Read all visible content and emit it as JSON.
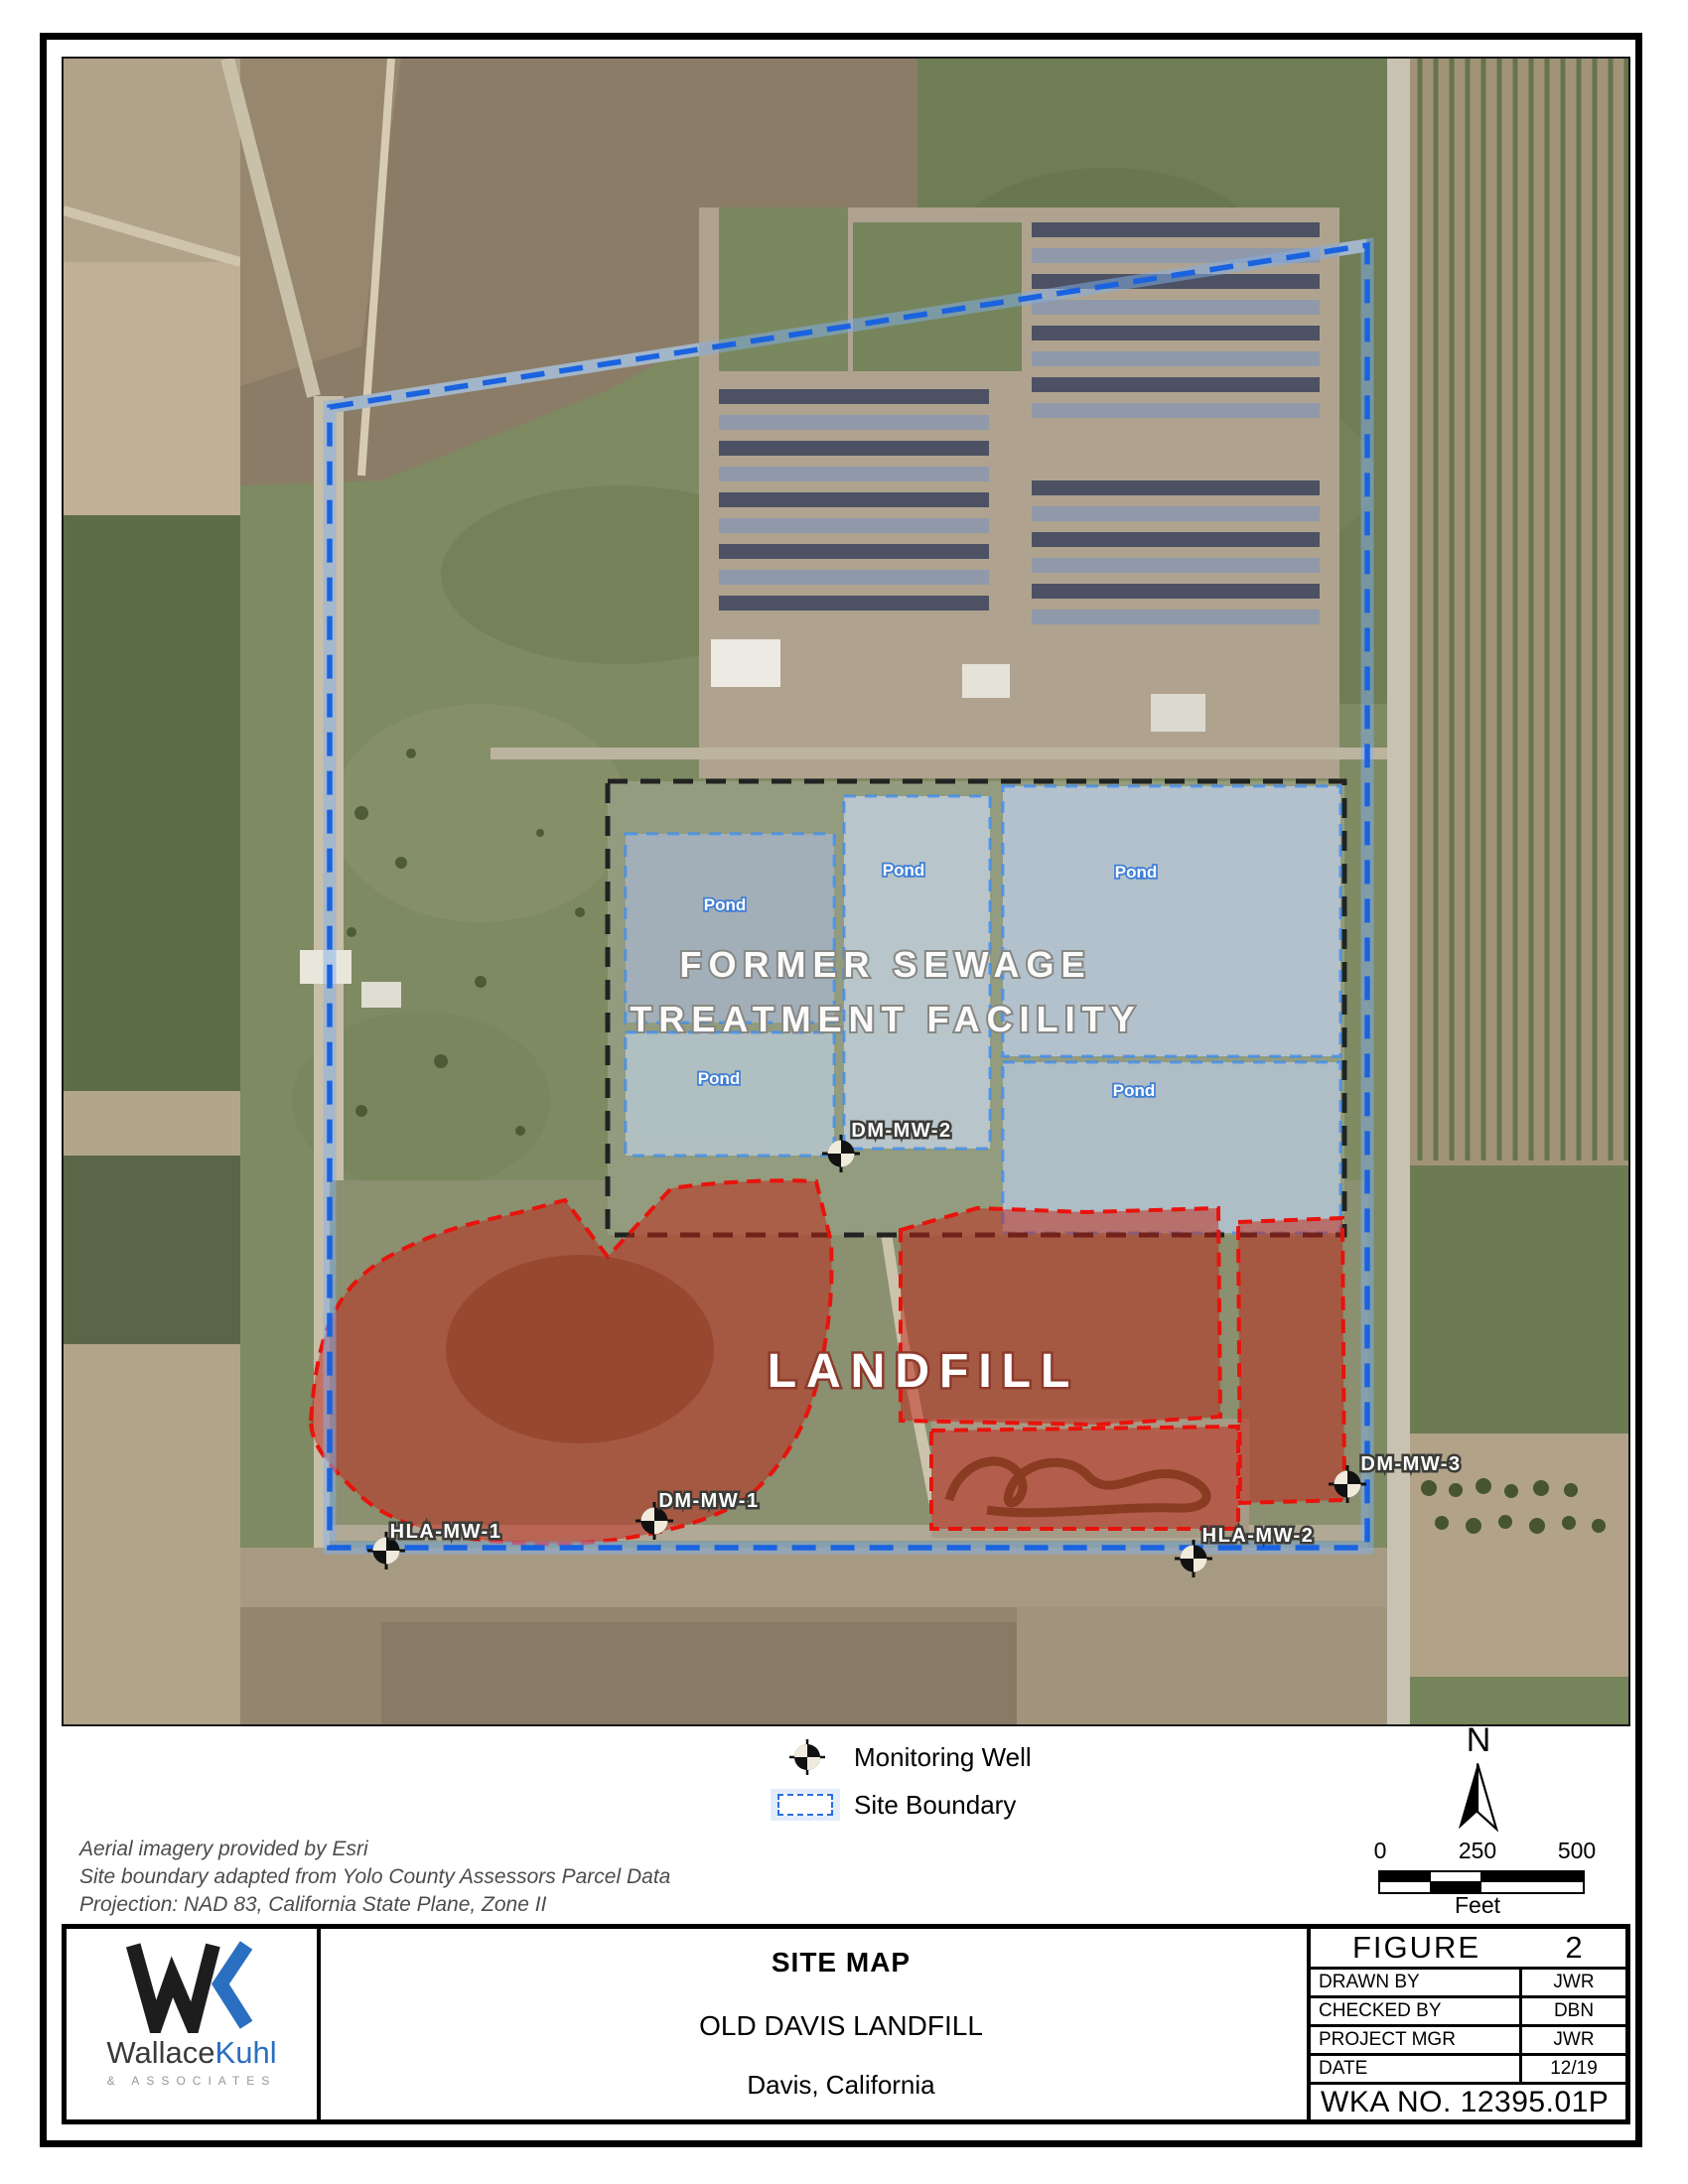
{
  "map": {
    "facility_label_line1": "FORMER SEWAGE",
    "facility_label_line2": "TREATMENT FACILITY",
    "landfill_label": "LANDFILL",
    "pond_labels": [
      "Pond",
      "Pond",
      "Pond",
      "Pond",
      "Pond"
    ],
    "wells": [
      {
        "id": "DM-MW-2"
      },
      {
        "id": "DM-MW-1"
      },
      {
        "id": "HLA-MW-1"
      },
      {
        "id": "HLA-MW-2"
      },
      {
        "id": "DM-MW-3"
      }
    ]
  },
  "legend": {
    "monitoring_well": "Monitoring Well",
    "site_boundary": "Site Boundary"
  },
  "compass": {
    "north_label": "N"
  },
  "scale_bar": {
    "ticks": [
      "0",
      "250",
      "500"
    ],
    "unit": "Feet"
  },
  "notes": {
    "line1": "Aerial imagery provided by Esri",
    "line2": "Site boundary adapted from Yolo County Assessors Parcel Data",
    "line3": "Projection: NAD 83, California State Plane, Zone II"
  },
  "title_block": {
    "map_title": "SITE MAP",
    "project_name": "OLD DAVIS LANDFILL",
    "location": "Davis, California",
    "figure_label": "FIGURE",
    "figure_number": "2",
    "rows": [
      {
        "label": "DRAWN BY",
        "value": "JWR"
      },
      {
        "label": "CHECKED BY",
        "value": "DBN"
      },
      {
        "label": "PROJECT MGR",
        "value": "JWR"
      },
      {
        "label": "DATE",
        "value": "12/19"
      }
    ],
    "wka_number": "WKA NO. 12395.01P"
  },
  "logo": {
    "word_part1": "Wallace",
    "word_part2": "Kuhl",
    "tagline": "& ASSOCIATES"
  },
  "colors": {
    "site_boundary_blue": "#1a63e0",
    "landfill_red": "#d91a12",
    "facility_outline": "#222222",
    "pond_outline": "#4a90e2",
    "logo_blue": "#2a6fc0"
  }
}
